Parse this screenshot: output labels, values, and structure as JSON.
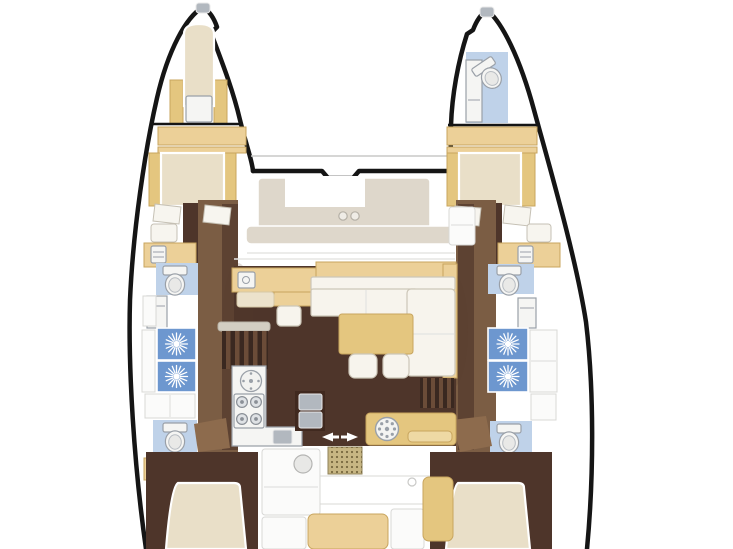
{
  "diagram": {
    "type": "catamaran-floorplan",
    "view": "top-down interior deck plan, no text labels, image cropped at stern"
  },
  "labels": {
    "plan": "catamaran deck plan",
    "port_hull": "port hull: bow berth, forward double cabin, head, two shower stalls, aft head, aft double cabin",
    "starboard_hull": "starboard hull: bow head, forward double cabin, head, two shower stalls, aft head, aft double cabin",
    "foredeck": "forward cockpit with U-shaped seat and cup holders",
    "salon": "salon with L-sofa, table, stools, nav seat and galley",
    "cockpit": "aft cockpit with benches, table, winch console and companionway mat"
  },
  "features": {
    "double_beds": 4,
    "bow_berths": 1,
    "toilets": 5,
    "shower_stalls": 4,
    "stove_burners": 4,
    "galley_sinks": 3,
    "salon_stools": 2,
    "companionway_steps": 2,
    "cup_holders": 2
  },
  "palette": {
    "outline": "#151515",
    "deckTan": "#ecd098",
    "tanStroke": "#c8a55e",
    "tableTan": "#e4c67f",
    "bedCream": "#e9dfc8",
    "pillowWhite": "#f7f5ef",
    "floorDark": "#4e352a",
    "floorMid": "#7b5d44",
    "floorMid2": "#5d4232",
    "doorBrown": "#8d6b4d",
    "bathBlue": "#bfd2e9",
    "showerBlue": "#6d97cf",
    "sunburst": "#ffffff",
    "fixtureWhite": "#f5f5f3",
    "fixtureStroke": "#9aa0a8",
    "seatGreige": "#ded7cb",
    "sofaWhite": "#f7f4ed",
    "sofaStroke": "#ccc6b8",
    "steel": "#b2b8bf",
    "matKhaki": "#c7b683",
    "matDot": "#77683f",
    "cockpitLine": "#e6e6e4",
    "shadow": "#5a3e2c"
  }
}
